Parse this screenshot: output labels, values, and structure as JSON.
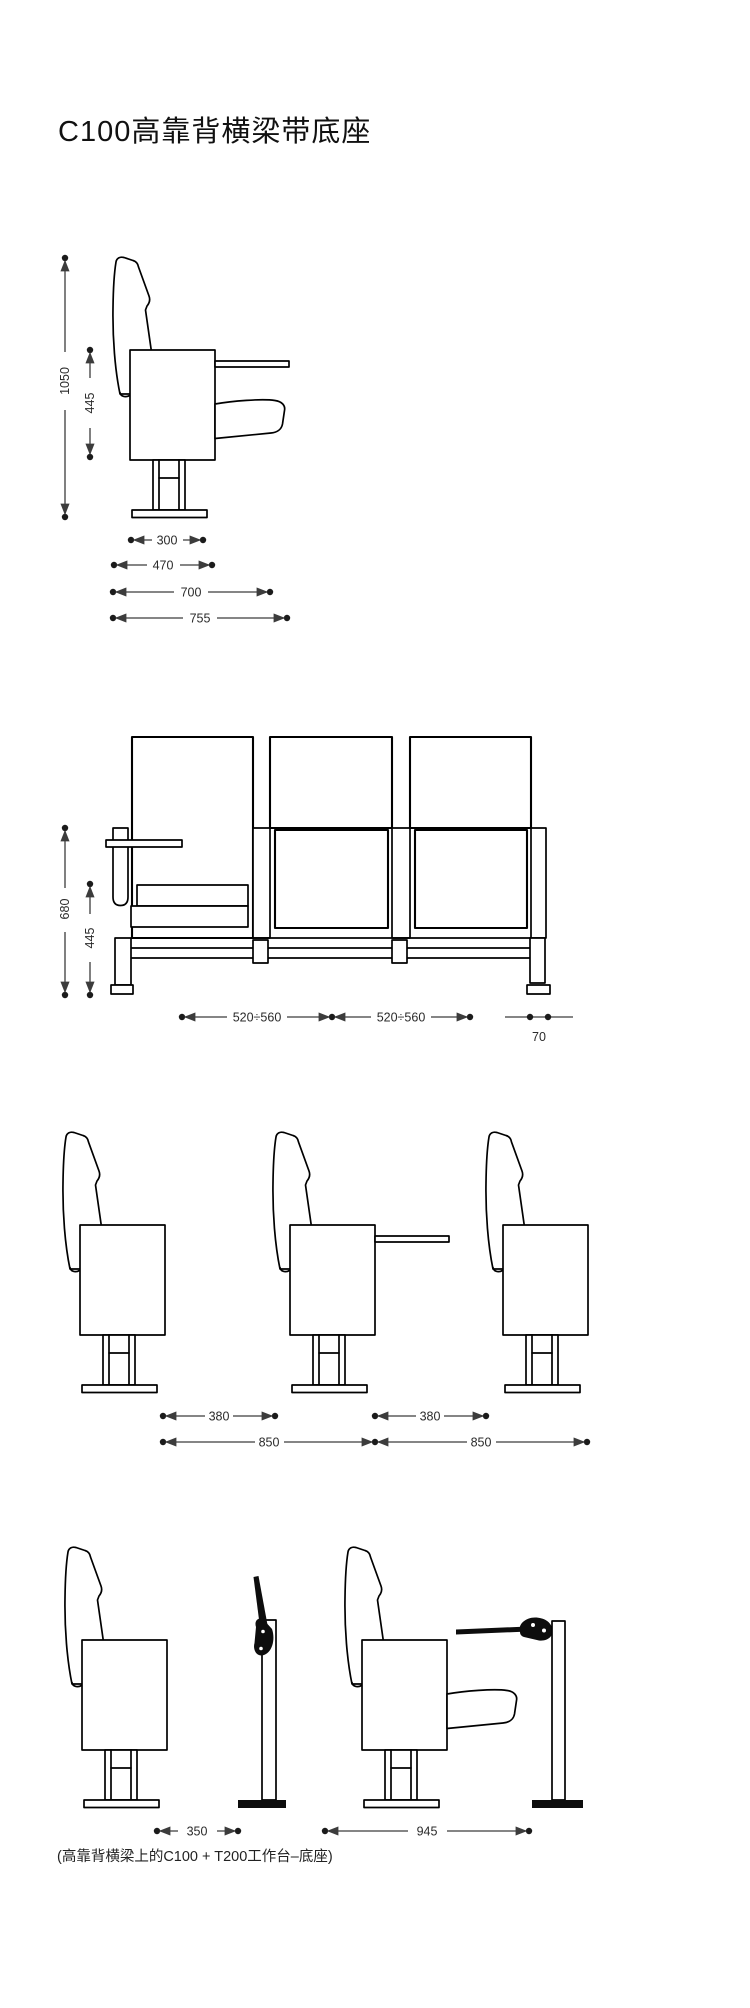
{
  "title": "C100高靠背横梁带底座",
  "caption": "(高靠背横梁上的C100 + T200工作台–底座)",
  "figures": {
    "fig1": {
      "dims": {
        "total_height": "1050",
        "seat_height": "445",
        "base_width": "300",
        "seat_depth": "470",
        "depth_closed": "700",
        "depth_overall": "755"
      }
    },
    "fig2": {
      "dims": {
        "back_height": "680",
        "seat_height": "445",
        "seat_pitch_left": "520÷560",
        "seat_pitch_right": "520÷560",
        "leg_offset": "70"
      }
    },
    "fig3": {
      "dims": {
        "clearance_left": "380",
        "clearance_right": "380",
        "row_spacing_left": "850",
        "row_spacing_right": "850"
      }
    },
    "fig4": {
      "dims": {
        "clearance": "350",
        "row_spacing": "945"
      }
    }
  }
}
